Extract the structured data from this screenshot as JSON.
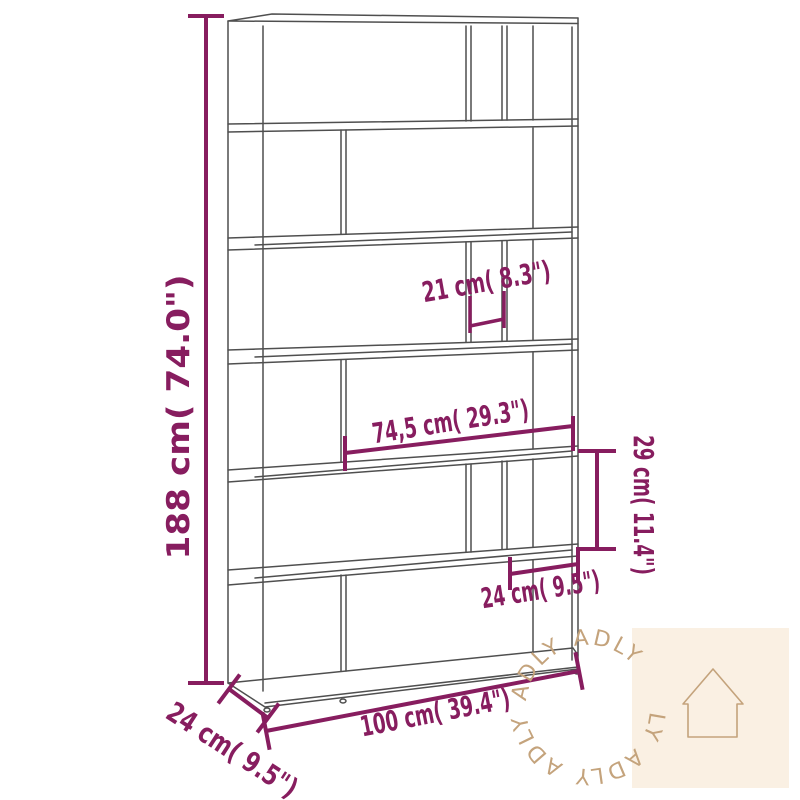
{
  "diagram": {
    "type": "furniture-dimension-drawing",
    "subject": "6-tier book cabinet / room divider",
    "labels": {
      "height": "188 cm( 74.0\")",
      "inner_width_small": "21 cm( 8.3\")",
      "inner_width_large": "74,5 cm( 29.3\")",
      "inner_height": "29 cm( 11.4\")",
      "inner_width_right": "24 cm( 9.5\")",
      "total_width": "100 cm( 39.4\")",
      "depth": "24 cm( 9.5\")"
    },
    "measurements": {
      "height_cm": 188,
      "height_in": 74.0,
      "inner_width_small_cm": 21,
      "inner_width_small_in": 8.3,
      "inner_width_large_cm": 74.5,
      "inner_width_large_in": 29.3,
      "inner_height_cm": 29,
      "inner_height_in": 11.4,
      "inner_width_right_cm": 24,
      "inner_width_right_in": 9.5,
      "total_width_cm": 100,
      "total_width_in": 39.4,
      "depth_cm": 24,
      "depth_in": 9.5
    },
    "colors": {
      "dimension_accent": "#871d5f",
      "drawing_line": "#4f4f4f",
      "background": "#ffffff",
      "watermark_bg": "#faf0e3",
      "watermark_fg": "#c4a37c"
    },
    "watermark": {
      "brand": "ADLY"
    }
  }
}
